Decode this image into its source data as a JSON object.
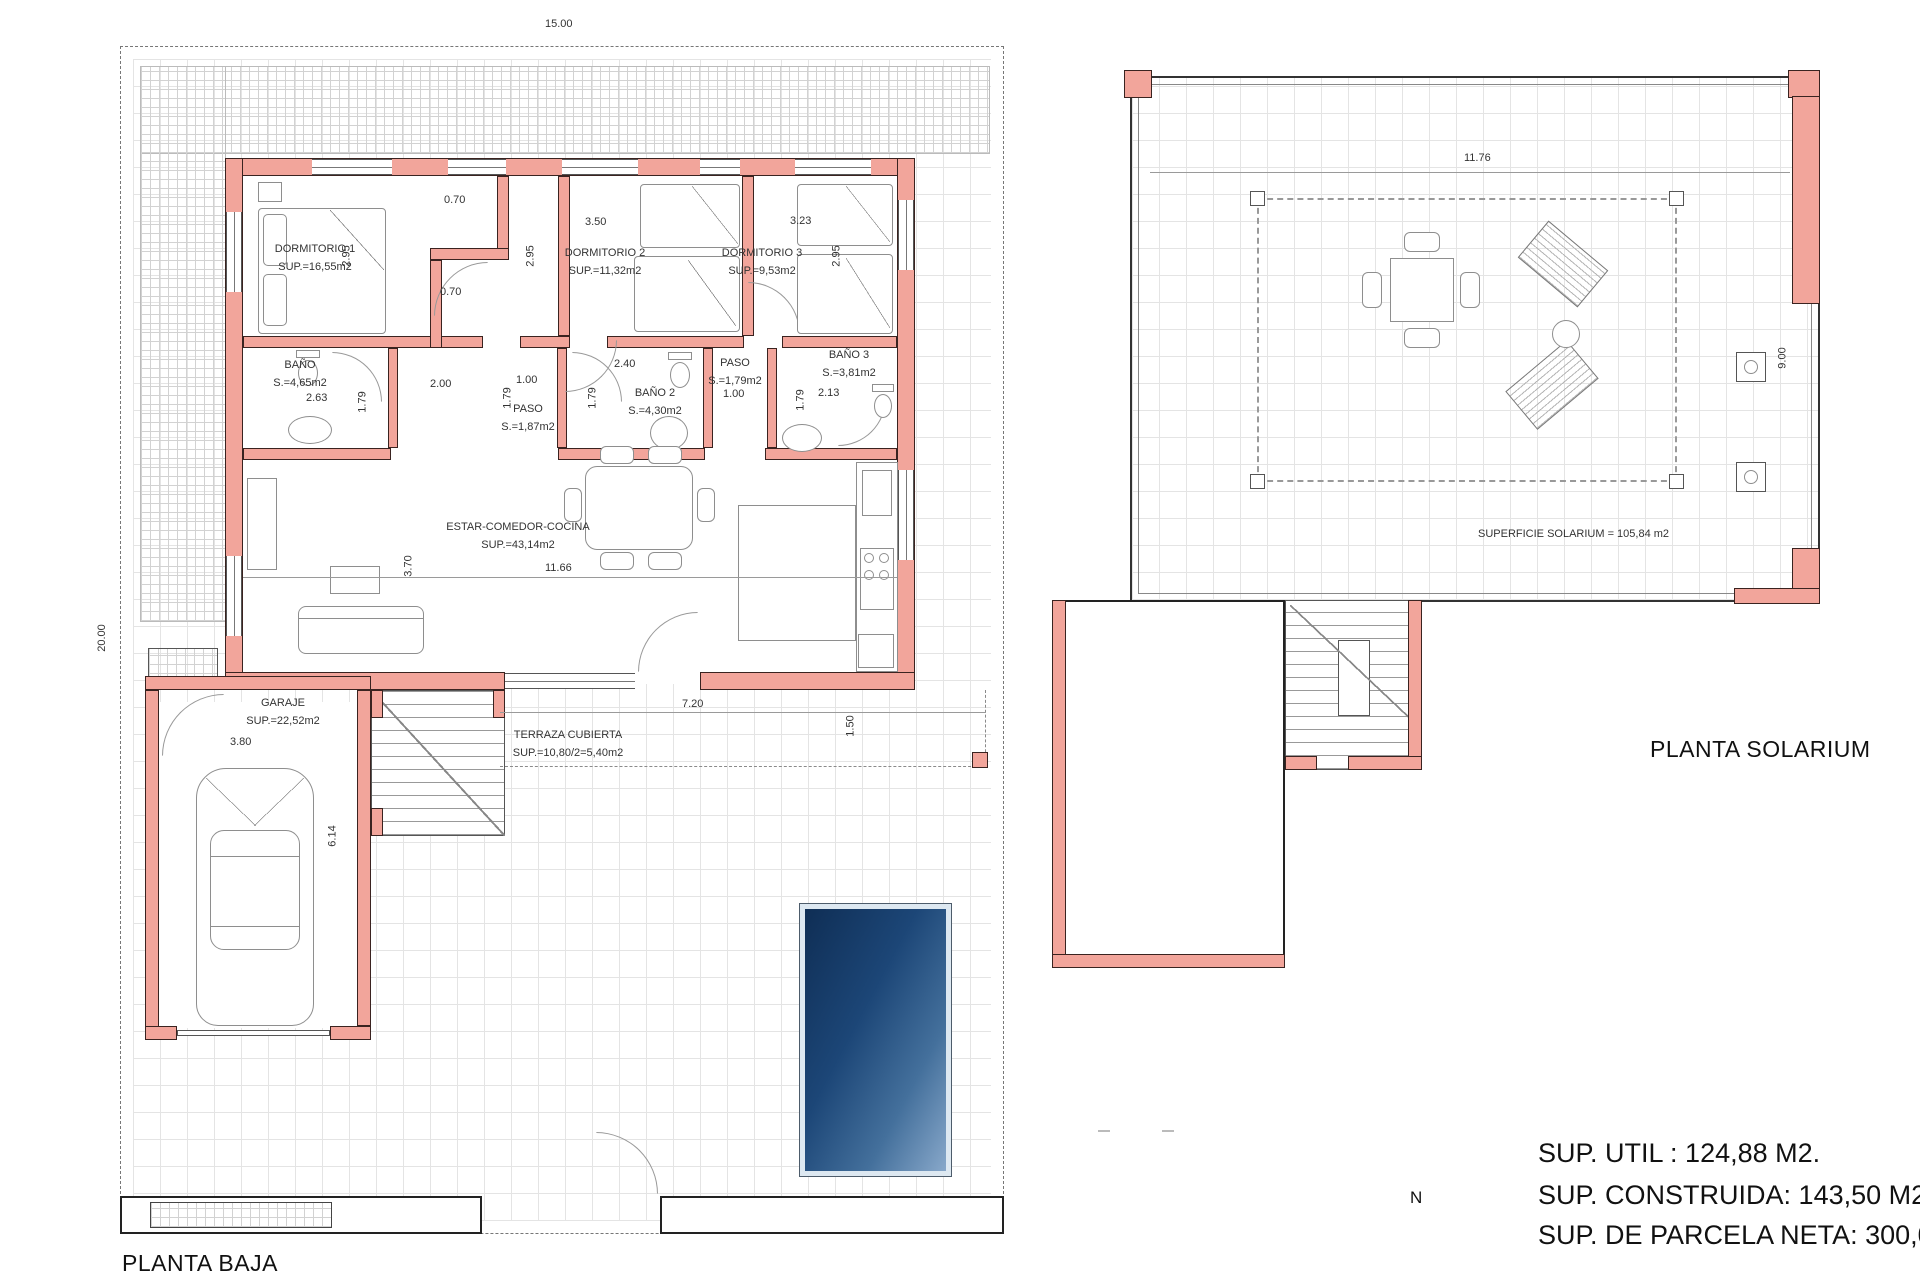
{
  "titles": {
    "planta_baja": "PLANTA BAJA",
    "planta_solarium": "PLANTA SOLARIUM"
  },
  "summary": {
    "util": "SUP. UTIL : 124,88 M2.",
    "construida": "SUP. CONSTRUIDA: 143,50 M2.",
    "parcela": "SUP. DE PARCELA NETA: 300,00 M2."
  },
  "compass_n": "N",
  "rooms": {
    "dorm1": {
      "name": "DORMITORIO 1",
      "area": "SUP.=16,55m2"
    },
    "dorm2": {
      "name": "DORMITORIO 2",
      "area": "SUP.=11,32m2"
    },
    "dorm3": {
      "name": "DORMITORIO 3",
      "area": "SUP.=9,53m2"
    },
    "bano1": {
      "name": "BAÑO",
      "area": "S.=4,65m2"
    },
    "paso1": {
      "name": "PASO",
      "area": "S.=1,87m2"
    },
    "bano2": {
      "name": "BAÑO 2",
      "area": "S.=4,30m2"
    },
    "paso2": {
      "name": "PASO",
      "area": "S.=1,79m2"
    },
    "bano3": {
      "name": "BAÑO 3",
      "area": "S.=3,81m2"
    },
    "estar": {
      "name": "ESTAR-COMEDOR-COCINA",
      "area": "SUP.=43,14m2"
    },
    "garaje": {
      "name": "GARAJE",
      "area": "SUP.=22,52m2"
    },
    "terraza": {
      "name": "TERRAZA CUBIERTA",
      "area": "SUP.=10,80/2=5,40m2"
    }
  },
  "solarium": {
    "surface_label": "SUPERFICIE SOLARIUM = 105,84 m2",
    "width": "11.76",
    "height": "9.00"
  },
  "dims": {
    "plot_width": "15.00",
    "plot_height": "20.00",
    "closet_top": "0.70",
    "closet_bottom": "0.70",
    "dorm1_h": "2.95",
    "dorm2_h": "2.95",
    "dorm3_h": "2.95",
    "dorm2_w": "3.50",
    "dorm3_w": "3.23",
    "bano1_w": "2.63",
    "bano1_h": "1.79",
    "paso1_w": "2.00",
    "paso1_h": "1.79",
    "paso1_w2": "1.00",
    "bano2_w": "2.40",
    "bano2_h": "1.79",
    "paso2_w": "1.00",
    "bano3_w": "2.13",
    "bano3_h": "1.79",
    "estar_w": "11.66",
    "estar_h": "3.70",
    "garaje_w": "3.80",
    "garaje_h": "6.14",
    "terraza_w": "7.20",
    "terraza_h": "1.50"
  }
}
